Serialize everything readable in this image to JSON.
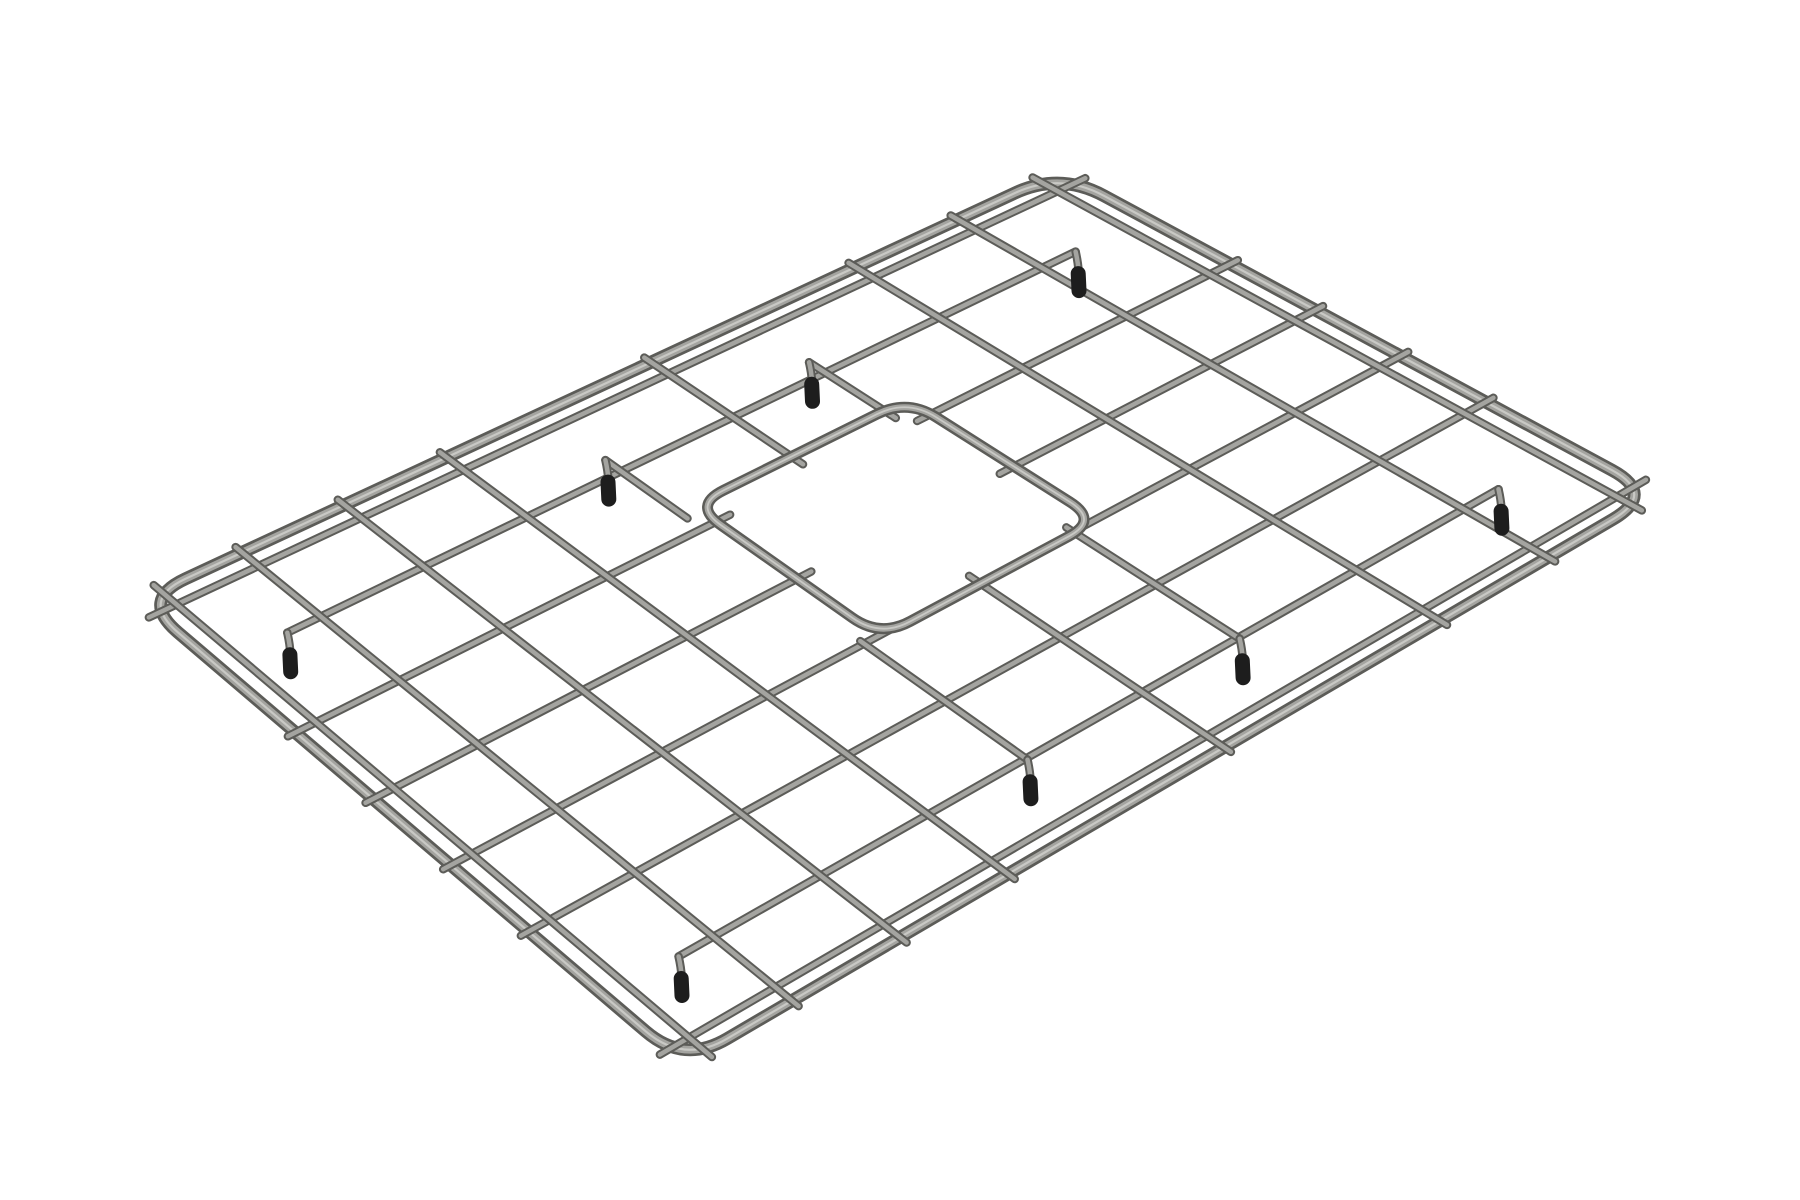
{
  "scene": {
    "description": "3D product render of a rectangular stainless steel sink bottom grid, viewed at an angle on a plain white background. The wire grid has a rounded-corner outer frame, a lattice of 9 by 7 cells, a rounded-square drain cutout right of center, and 8 down-turned wire feet capped with black rubber tips.",
    "background_color": "#ffffff",
    "object": {
      "type": "sink-bottom-grid",
      "material": "stainless-steel-wire",
      "grid_columns": 9,
      "grid_rows": 7,
      "drain_opening_shape": "rounded-square",
      "feet_count": 8,
      "feet_tip_color": "#1d1d1d"
    },
    "colors": {
      "background": "#ffffff",
      "steel_edge": "#5c5c58",
      "steel_core": "#a4a4a0",
      "steel_sheen": "#c9c9c5",
      "rubber_foot": "#1d1d1d"
    }
  },
  "render": {
    "corners": {
      "L": [
        140,
        600
      ],
      "T": [
        1060,
        172
      ],
      "R": [
        1656,
        494
      ],
      "B": [
        684,
        1064
      ]
    },
    "frame_radius": 50,
    "ring": {
      "u0": 0.45,
      "u1": 0.68,
      "v0": 0.245,
      "v1": 0.575,
      "radius": 34
    },
    "long_wires": [
      {
        "v": 0.03,
        "spans": [
          [
            -0.008,
            1.008
          ]
        ]
      },
      {
        "v": 0.1429,
        "spans": [
          [
            0.075,
            0.925
          ]
        ]
      },
      {
        "v": 0.2857,
        "spans": [
          [
            -0.008,
            0.465
          ],
          [
            0.665,
            1.008
          ]
        ]
      },
      {
        "v": 0.4286,
        "spans": [
          [
            -0.008,
            0.465
          ],
          [
            0.665,
            1.008
          ]
        ]
      },
      {
        "v": 0.5714,
        "spans": [
          [
            -0.008,
            0.465
          ],
          [
            0.665,
            1.008
          ]
        ]
      },
      {
        "v": 0.7143,
        "spans": [
          [
            -0.008,
            1.008
          ]
        ]
      },
      {
        "v": 0.8571,
        "spans": [
          [
            0.075,
            0.925
          ]
        ]
      },
      {
        "v": 0.97,
        "spans": [
          [
            -0.008,
            1.008
          ]
        ]
      }
    ],
    "cross_wires": [
      {
        "u": 0.022,
        "spans": [
          [
            -0.012,
            1.012
          ]
        ]
      },
      {
        "u": 0.1111,
        "spans": [
          [
            -0.012,
            1.012
          ]
        ]
      },
      {
        "u": 0.2222,
        "spans": [
          [
            -0.012,
            1.012
          ]
        ]
      },
      {
        "u": 0.3333,
        "spans": [
          [
            -0.012,
            1.012
          ]
        ]
      },
      {
        "u": 0.435,
        "spans": [
          [
            0.115,
            0.26
          ],
          [
            0.565,
            0.86
          ]
        ]
      },
      {
        "u": 0.5556,
        "spans": [
          [
            -0.012,
            0.265
          ],
          [
            0.555,
            1.012
          ]
        ]
      },
      {
        "u": 0.655,
        "spans": [
          [
            0.115,
            0.265
          ],
          [
            0.56,
            0.86
          ]
        ]
      },
      {
        "u": 0.7778,
        "spans": [
          [
            -0.012,
            1.012
          ]
        ]
      },
      {
        "u": 0.8889,
        "spans": [
          [
            -0.012,
            1.012
          ]
        ]
      },
      {
        "u": 0.978,
        "spans": [
          [
            -0.012,
            1.012
          ]
        ]
      }
    ],
    "feet": [
      [
        0.075,
        0.1429
      ],
      [
        0.925,
        0.1429
      ],
      [
        0.075,
        0.8571
      ],
      [
        0.925,
        0.8571
      ],
      [
        0.435,
        0.115
      ],
      [
        0.435,
        0.86
      ],
      [
        0.655,
        0.115
      ],
      [
        0.655,
        0.86
      ]
    ],
    "strokes": {
      "frame": {
        "edge_w": 13,
        "core_w": 7.5,
        "sheen_w": 2.2
      },
      "lattice": {
        "edge_w": 8.5,
        "core_w": 4.5
      },
      "ring": {
        "edge_w": 11,
        "core_w": 6,
        "sheen_w": 1.8
      },
      "foot": {
        "cap_w": 15,
        "cap_len": 17,
        "drop": 20
      }
    }
  }
}
